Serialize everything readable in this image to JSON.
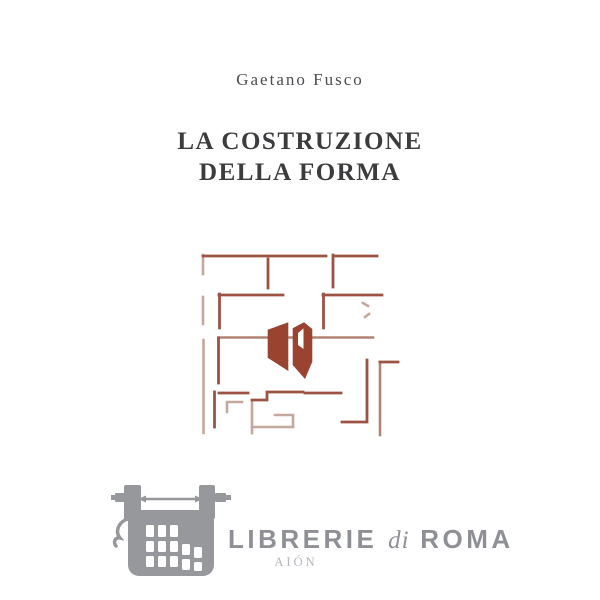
{
  "cover": {
    "author": "Gaetano Fusco",
    "title_line1": "LA COSTRUZIONE",
    "title_line2": "DELLA FORMA",
    "figure": "architectural-floor-plan-motif",
    "colors": {
      "title_text": "#3c3c3e",
      "author_text": "#4d4d52",
      "plan_line_dark": "#9d5343",
      "plan_line_light": "#c5a89d",
      "plan_fill": "#9a4330"
    }
  },
  "watermark": {
    "icon": "typewriter-icon",
    "bookstore": "LIBRERIE",
    "di": "di",
    "city": "ROMA",
    "publisher": "AIÓN",
    "colors": {
      "logo_gray": "#97989c",
      "text_gray": "#8f9095",
      "publisher_gray": "#b5b6bc"
    }
  }
}
